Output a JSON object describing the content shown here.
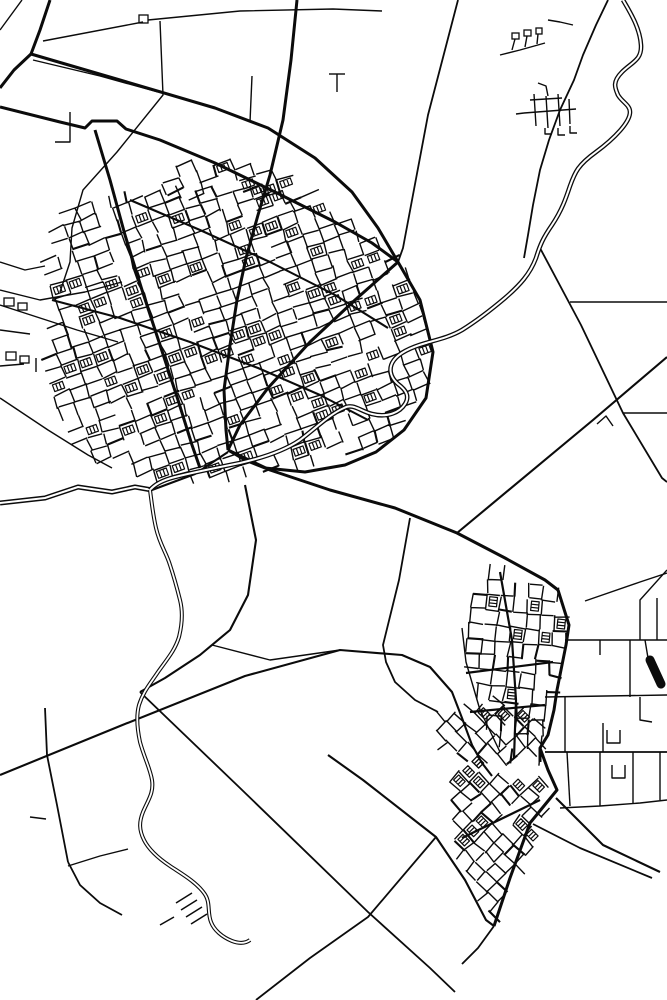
{
  "map": {
    "width": 667,
    "height": 1000,
    "background": "#ffffff",
    "ink": "#0b0b0b",
    "layers": [
      {
        "name": "field-roads-thin",
        "width": 1.4,
        "paths": [
          "M22,0 L0,30",
          "M43,41 L143,22",
          "M148,20 L240,11 L333,9 L382,11",
          "M160,21 L163,95 L117,152 L83,190 L72,228 L70,262 L60,292",
          "M70,112 L70,142 L55,142",
          "M250,122 L252,76",
          "M33,60 L100,76 L158,92",
          "M329,74 L345,74",
          "M337,74 L337,92",
          "M0,262 L25,270 L45,266",
          "M0,290 L40,300 L85,292 L122,282",
          "M0,330 L30,334",
          "M0,366 L24,364",
          "M36,358 L36,372",
          "M0,398 L48,430 L88,455 L112,468",
          "M0,305 L40,318 L77,330 L118,342",
          "M570,302 L667,302",
          "M623,413 L667,413",
          "M597,424 L606,416 L613,426",
          "M573,25 L560,22 L548,20",
          "M500,55 L520,50 L545,43",
          "M515,39 L512,50",
          "M527,36 L525,47",
          "M538,34 L537,44",
          "M530,100 L562,98",
          "M524,113 L576,109",
          "M534,94 L536,126",
          "M546,96 L548,128",
          "M558,94 L560,126",
          "M569,99 L570,124",
          "M545,128 L545,134 L552,134",
          "M558,128 L558,135 L565,135",
          "M570,126 L570,133 L577,133",
          "M516,114 L524,113",
          "M548,96 L546,86 L538,83",
          "M212,645 L270,660 L340,650",
          "M30,817 L46,819",
          "M68,866 L100,856 L128,849",
          "M667,570 L640,600 L640,640",
          "M585,601 L640,582 L667,573",
          "M565,640 L667,640",
          "M657,598 L657,640",
          "M645,640 L648,658",
          "M545,697 L667,695",
          "M630,640 L630,697",
          "M600,640 L600,655",
          "M565,697 L565,752",
          "M567,752 L570,806",
          "M603,723 L603,752",
          "M607,730 L607,743 L620,743 L620,730",
          "M640,697 L640,720 L652,722",
          "M600,752 L600,806",
          "M633,752 L633,804",
          "M660,752 L660,800",
          "M560,808 L600,806 L640,803 L667,800",
          "M612,765 L612,778 L625,778 L625,765",
          "M462,628 L466,662 L480,710 L500,752"
        ]
      },
      {
        "name": "rural-roads-medium",
        "width": 1.8,
        "paths": [
          "M458,0 L428,115 L403,248 L398,262",
          "M540,248 L581,325 L623,413 L662,478 L667,482",
          "M608,0 L596,25 L583,55 L574,80 L560,110 L549,140 L540,170 L533,205 L528,235 L524,258",
          "M410,518 L399,580 L383,645 L386,662 L395,682 L415,700 L438,712",
          "M140,692 L240,788 L368,912 L430,968 L455,992",
          "M256,1000 L310,958 L368,917 L436,837",
          "M45,708 L47,755 L57,805 L68,862",
          "M68,862 L80,885 L100,903 L122,915",
          "M494,926 L478,948 L462,964",
          "M545,752 L667,752",
          "M533,824 L580,848 L652,878"
        ]
      },
      {
        "name": "connector-roads",
        "width": 2.1,
        "paths": [
          "M667,357 L593,420 L457,533",
          "M245,485 L256,540 L248,595 L230,630 L200,655 L165,678 L140,692",
          "M0,775 L120,726 L245,676 L340,650 L402,655 L430,667 L452,692 L462,718 L472,745 L482,763 L492,776",
          "M556,798 L603,845 L660,872",
          "M328,755 L363,780 L436,837 L465,880 L486,920 L494,926",
          "M152,490 L195,474 L228,452",
          "M130,200 L200,230 L270,262 L335,295 L388,328",
          "M52,300 L120,318 L190,342 L258,368 L320,395 L368,420"
        ]
      },
      {
        "name": "arteries",
        "width": 3.0,
        "paths": [
          "M50,0 L40,30 L31,54",
          "M31,54 L14,70 L0,88",
          "M31,54 L120,80 L215,108 L268,128 L315,158 L352,192 L378,228 L398,262",
          "M0,107 L60,122 L85,128 L92,121 L117,121 L126,129 L160,140 L215,163 L275,192 L335,222 L372,243 L398,262",
          "M297,0 L291,60 L283,120 L270,175 L258,215 L246,258 L237,300 L230,345 L224,390 L226,430 L228,450",
          "M398,262 L355,300 L310,342 L268,388 L240,425 L228,450",
          "M398,262 L420,300 L433,352 L426,398 L404,430 L376,452 L345,465 L305,472 L265,468 L245,460 L228,450",
          "M228,450 L270,470 L330,490 L395,508 L457,533 L505,558 L545,580 L558,590",
          "M95,130 L110,180 L125,235 L142,290 L160,345 L178,400 L192,445 L200,468",
          "M558,590 L569,625 L566,645 L557,690 L554,710 L548,735 L540,748 L540,762",
          "M540,748 L548,770 L557,790 L530,823 L510,878 L494,926"
        ]
      },
      {
        "name": "town-collectors",
        "width": 2.2,
        "paths": [
          "M466,673 L553,662",
          "M470,712 L545,705",
          "M500,572 L512,640 L516,700 L514,758",
          "M462,838 L540,800"
        ]
      }
    ],
    "double_roads": [
      {
        "name": "canal-road",
        "outer": 5.0,
        "inner": 2.0,
        "path": "M0,503 L45,498 L78,487 L112,492 L135,487 L152,490"
      },
      {
        "name": "river-upper",
        "outer": 4.6,
        "inner": 2.0,
        "path": "M623,0 C630,12 640,28 641,45 C642,60 632,62 622,72 C612,82 615,88 618,95 C622,102 630,105 630,112 C630,122 615,138 596,152 C578,165 575,172 570,186 C566,198 562,210 552,225 C543,238 540,245 536,258 C530,274 520,285 505,298 C492,309 478,320 462,330 C450,337 436,340 426,343 C412,347 400,352 394,360 C388,368 390,377 398,384 C406,390 410,396 405,404 C400,412 388,418 372,414 C360,411 353,403 344,408 C330,414 316,428 300,440 C284,451 262,458 240,463 C220,467 195,472 175,477 C163,480 155,484 150,490"
      },
      {
        "name": "stream-south",
        "outer": 4.0,
        "inner": 1.8,
        "path": "M150,490 C152,505 153,515 156,528 C160,545 166,552 170,565 C174,577 177,588 180,600 C183,612 182,625 179,637 C175,650 168,658 158,672 C150,684 143,692 139,705 C136,716 137,728 140,742 C144,757 150,768 152,780 C154,793 148,800 143,812 C139,822 139,830 144,840 C149,850 158,858 170,866 C182,874 196,882 204,893 C211,902 207,912 211,922 C214,930 222,937 232,941 C240,944 246,943 250,940"
      }
    ],
    "hatches": {
      "name": "embankment-ticks",
      "width": 1.5,
      "paths": [
        "M176,903 L192,893",
        "M181,910 L197,900",
        "M186,917 L202,907",
        "M191,924 L207,914",
        "M160,925 L174,917"
      ]
    },
    "blobs": [
      {
        "name": "depot-blob",
        "width": 9,
        "path": "M650,660 L661,684"
      }
    ],
    "building_rects": [
      [
        139,
        15,
        9,
        8
      ],
      [
        4,
        298,
        10,
        8
      ],
      [
        18,
        303,
        9,
        7
      ],
      [
        6,
        352,
        10,
        8
      ],
      [
        20,
        356,
        9,
        7
      ],
      [
        512,
        33,
        7,
        6
      ],
      [
        524,
        30,
        7,
        6
      ],
      [
        536,
        28,
        6,
        6
      ]
    ],
    "districts": [
      {
        "name": "upper-town-main",
        "polygon": [
          [
            62,
            208
          ],
          [
            130,
            193
          ],
          [
            200,
            186
          ],
          [
            262,
            188
          ],
          [
            322,
            208
          ],
          [
            372,
            232
          ],
          [
            400,
            260
          ],
          [
            420,
            298
          ],
          [
            432,
            345
          ],
          [
            427,
            392
          ],
          [
            405,
            428
          ],
          [
            372,
            452
          ],
          [
            330,
            462
          ],
          [
            285,
            470
          ],
          [
            240,
            477
          ],
          [
            195,
            480
          ],
          [
            150,
            482
          ],
          [
            112,
            470
          ],
          [
            82,
            450
          ],
          [
            62,
            422
          ],
          [
            50,
            385
          ],
          [
            46,
            340
          ],
          [
            52,
            300
          ],
          [
            48,
            262
          ],
          [
            52,
            230
          ]
        ],
        "angle": -20,
        "cell_u": 17,
        "cell_v": 13,
        "seed": 7,
        "density": 0.78,
        "ladder": 0.16
      },
      {
        "name": "upper-town-north",
        "polygon": [
          [
            150,
            168
          ],
          [
            210,
            156
          ],
          [
            270,
            164
          ],
          [
            322,
            186
          ],
          [
            302,
            202
          ],
          [
            240,
            194
          ],
          [
            185,
            198
          ],
          [
            152,
            188
          ]
        ],
        "angle": -20,
        "cell_u": 18,
        "cell_v": 12,
        "seed": 11,
        "density": 0.6,
        "ladder": 0.12
      },
      {
        "name": "lower-town-north",
        "polygon": [
          [
            468,
            602
          ],
          [
            492,
            565
          ],
          [
            520,
            578
          ],
          [
            558,
            592
          ],
          [
            571,
            625
          ],
          [
            565,
            648
          ],
          [
            552,
            700
          ],
          [
            543,
            745
          ],
          [
            538,
            765
          ],
          [
            505,
            758
          ],
          [
            480,
            710
          ],
          [
            466,
            662
          ],
          [
            462,
            628
          ]
        ],
        "angle": 96,
        "cell_u": 15,
        "cell_v": 14,
        "seed": 23,
        "density": 0.78,
        "ladder": 0.14
      },
      {
        "name": "lower-town-mid",
        "polygon": [
          [
            425,
            715
          ],
          [
            505,
            698
          ],
          [
            548,
            722
          ],
          [
            540,
            757
          ],
          [
            478,
            768
          ],
          [
            438,
            748
          ]
        ],
        "angle": 45,
        "cell_u": 15,
        "cell_v": 13,
        "seed": 31,
        "density": 0.72,
        "ladder": 0.12
      },
      {
        "name": "lower-town-diamond",
        "polygon": [
          [
            470,
            760
          ],
          [
            556,
            786
          ],
          [
            524,
            866
          ],
          [
            494,
            924
          ],
          [
            455,
            850
          ],
          [
            450,
            800
          ],
          [
            455,
            772
          ]
        ],
        "angle": 45,
        "cell_u": 15,
        "cell_v": 13,
        "seed": 37,
        "density": 0.78,
        "ladder": 0.14
      }
    ]
  }
}
